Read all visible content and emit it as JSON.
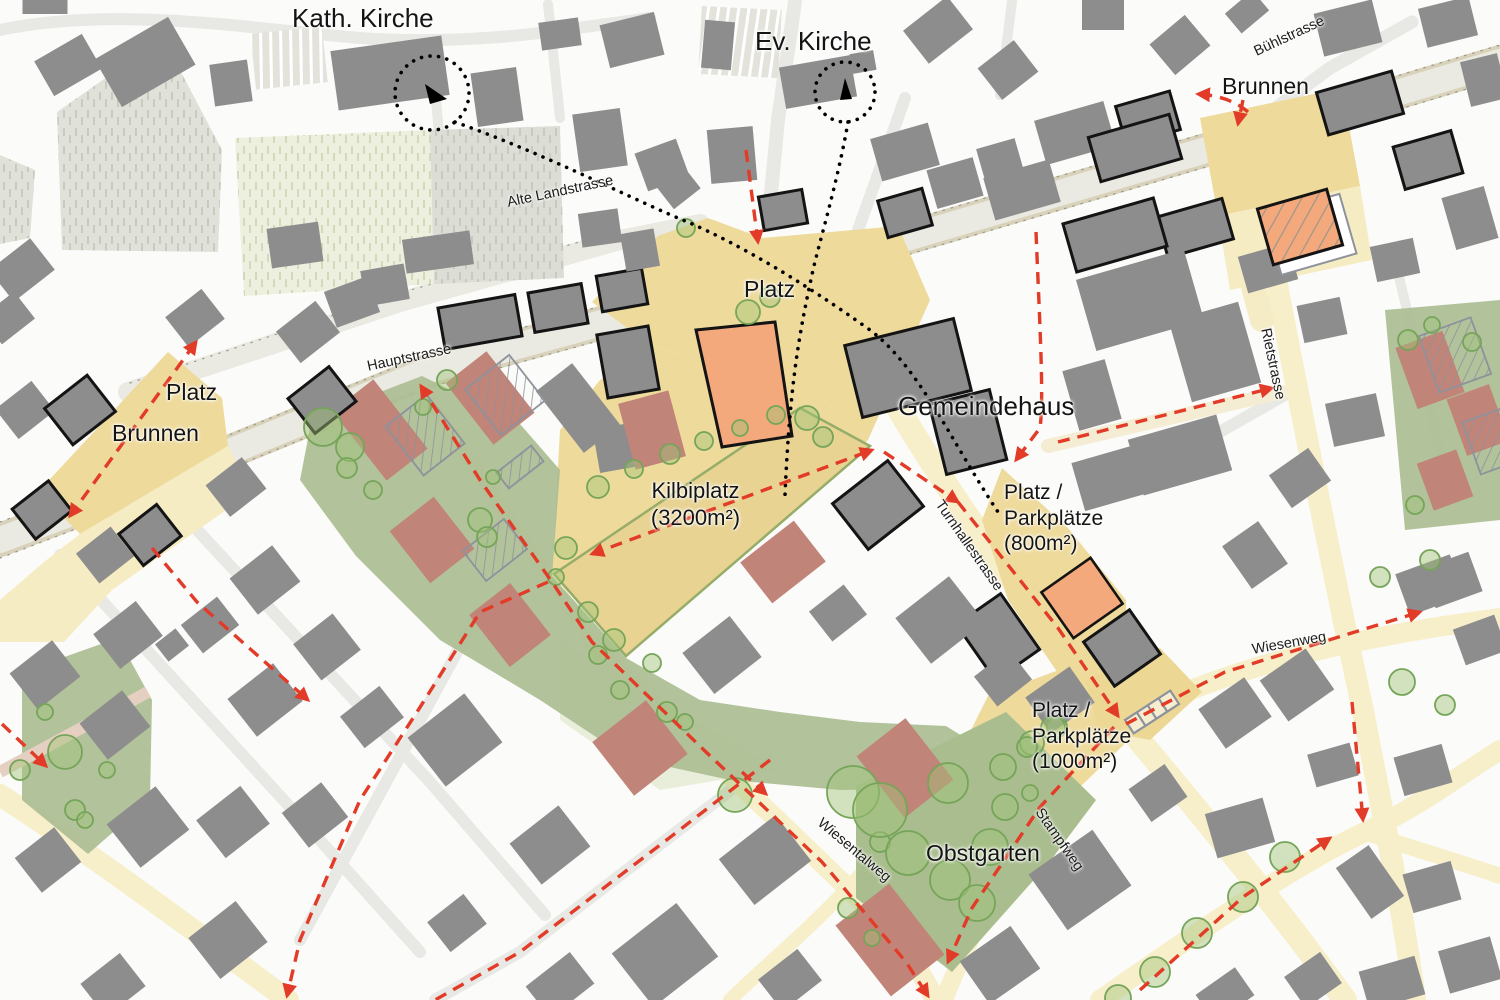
{
  "map": {
    "places": {
      "kath_kirche": "Kath. Kirche",
      "ev_kirche": "Ev. Kirche",
      "brunnen_top": "Brunnen",
      "platz_center": "Platz",
      "gemeindehaus": "Gemeindehaus",
      "platz_left": "Platz",
      "brunnen_left": "Brunnen",
      "kilbiplatz_name": "Kilbiplatz",
      "kilbiplatz_area": "(3200m²)",
      "pp800_l1": "Platz /",
      "pp800_l2": "Parkplätze",
      "pp800_l3": "(800m²)",
      "pp1000_l1": "Platz /",
      "pp1000_l2": "Parkplätze",
      "pp1000_l3": "(1000m²)",
      "obstgarten": "Obstgarten"
    },
    "streets": {
      "alte_landstrasse": "Alte Landstrasse",
      "hauptstrasse": "Hauptstrasse",
      "buehlstrasse": "Bühlstrasse",
      "rietstrasse": "Rietstrasse",
      "turnhallestrasse": "Turnhallestrasse",
      "wiesenweg": "Wiesenweg",
      "wiesentalweg": "Wiesentalweg",
      "stampfweg": "Stampfweg"
    },
    "colors": {
      "plaza_yellow": "#eeda9b",
      "street_yellow": "#f7efca",
      "green_area": "#abbd92",
      "building_gray": "#8d8d8d",
      "building_existing_red": "#c18478",
      "building_new_orange": "#f3a97c",
      "route_red": "#e23b28",
      "tree_green": "#76a55a"
    }
  }
}
